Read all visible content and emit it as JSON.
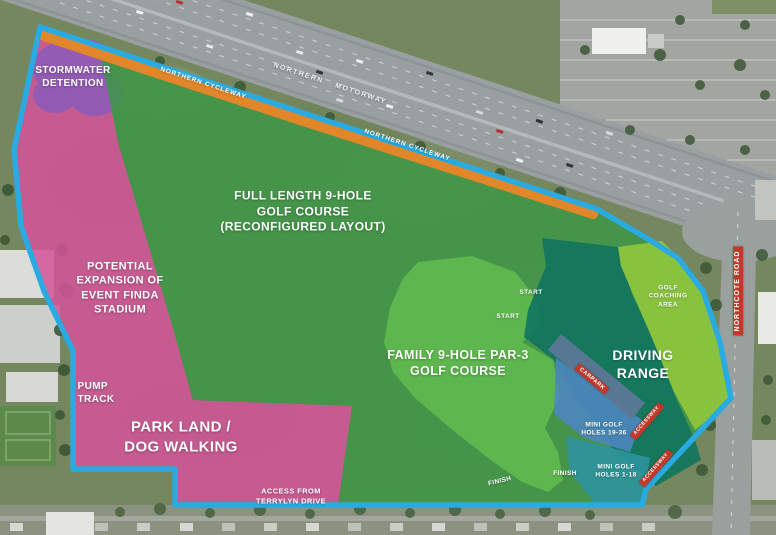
{
  "colors": {
    "boundary_blue": "#29abe2",
    "cycleway_orange": "#e2862a",
    "zone_pink": "#d4539a",
    "zone_purple": "#8f5cb8",
    "zone_green_main": "#3d9747",
    "zone_green_par3": "#62bb4e",
    "zone_teal_driving": "#10745f",
    "zone_green_coaching": "#8fc73d",
    "zone_blue_minigolf_19_36": "#4e86c2",
    "zone_teal_minigolf_1_18": "#2e93a0",
    "zone_carpark_grey": "#5c7795",
    "label_red": "#c0392b"
  },
  "labels": {
    "stormwater": "STORMWATER\nDETENTION",
    "cycleway_1": "NORTHERN CYCLEWAY",
    "motorway": "NORTHERN MOTORWAY",
    "cycleway_2": "NORTHERN CYCLEWAY",
    "full_course": "FULL LENGTH 9-HOLE\nGOLF COURSE\n(RECONFIGURED LAYOUT)",
    "expansion": "POTENTIAL\nEXPANSION OF\nEVENT FINDA\nSTADIUM",
    "pump_track": "PUMP\nTRACK",
    "park_land": "PARK LAND /\nDOG WALKING",
    "access": "ACCESS FROM\nTERRYLYN DRIVE",
    "family_course": "FAMILY 9-HOLE PAR-3\nGOLF COURSE",
    "start_1": "START",
    "start_2": "START",
    "coaching": "GOLF\nCOACHING\nAREA",
    "driving_range": "DRIVING\nRANGE",
    "carpark": "CARPARK",
    "minigolf_19_36": "MINI GOLF\nHOLES 19-36",
    "minigolf_1_18": "MINI GOLF\nHOLES 1-18",
    "accessway_1": "ACCESSWAY",
    "accessway_2": "ACCESSWAY",
    "northcote_road": "NORTHCOTE ROAD",
    "finish_1": "FINISH",
    "finish_2": "FINISH"
  }
}
